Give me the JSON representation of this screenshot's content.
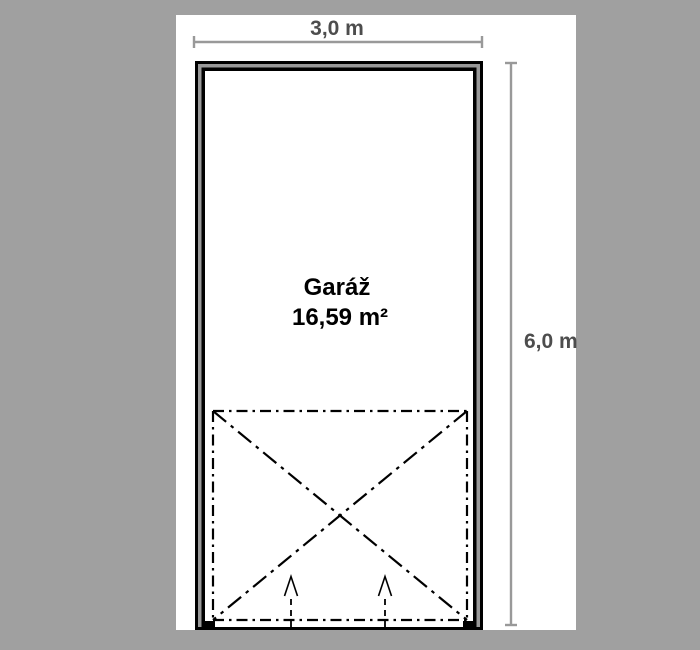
{
  "plan": {
    "room_label": "Garáž",
    "room_area": "16,59 m²",
    "width_dimension": "3,0 m",
    "height_dimension": "6,0 m"
  },
  "colors": {
    "background": "#a0a0a0",
    "sheet": "#ffffff",
    "wall_line": "#000000",
    "wall_fill": "#999999",
    "dimension_line": "#999999",
    "dimension_text": "#4d4d4d",
    "room_text": "#000000"
  }
}
